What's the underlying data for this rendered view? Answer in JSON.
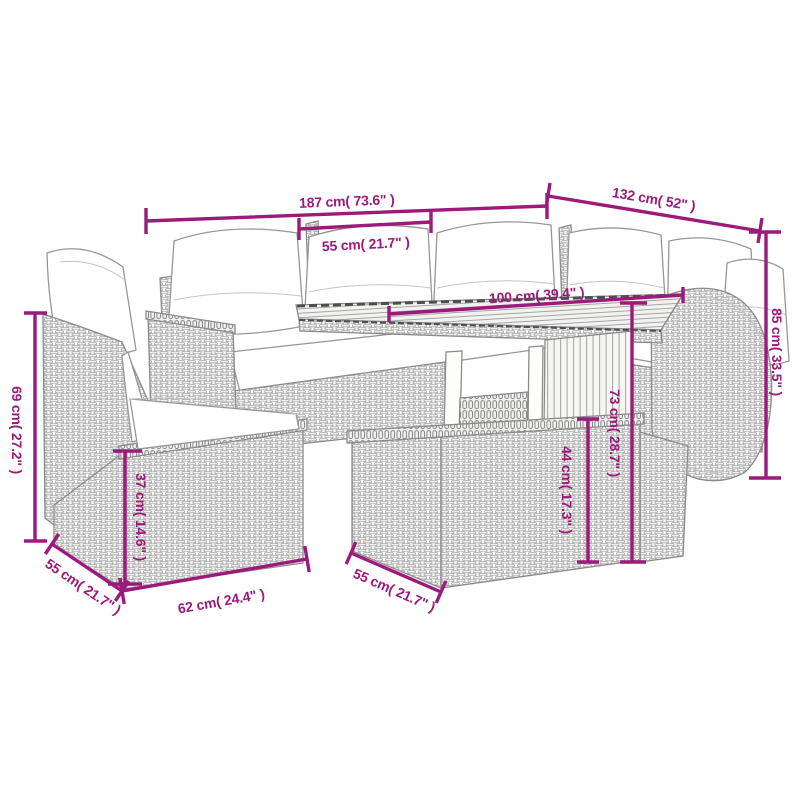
{
  "diagram": {
    "background": "#ffffff",
    "accent_color": "#9C1A7C",
    "line_art_color": "#8b8b8b",
    "alt_description": "Line drawing of a rattan garden lounge set (corner sofa, chair, stools and slatted-top table) with cushions, annotated with dimensions",
    "dimensions": {
      "sofa_total_width": "187 cm( 73.6\" )",
      "corner_section_width": "132 cm( 52\" )",
      "seat_cushion_width": "55 cm( 21.7\" )",
      "table_top_length": "100 cm( 39.4\" )",
      "sofa_back_height": "85 cm( 33.5\" )",
      "chair_back_height": "69 cm( 27.2\" )",
      "stool_height": "37 cm( 14.6\" )",
      "stool_side_depth": "55 cm( 21.7\" )",
      "stool_front_width": "62 cm( 24.4\" )",
      "footstool_side_depth": "55 cm( 21.7\" )",
      "table_height": "73 cm( 28.7\" )",
      "footstool_height": "44 cm( 17.3\" )"
    }
  }
}
